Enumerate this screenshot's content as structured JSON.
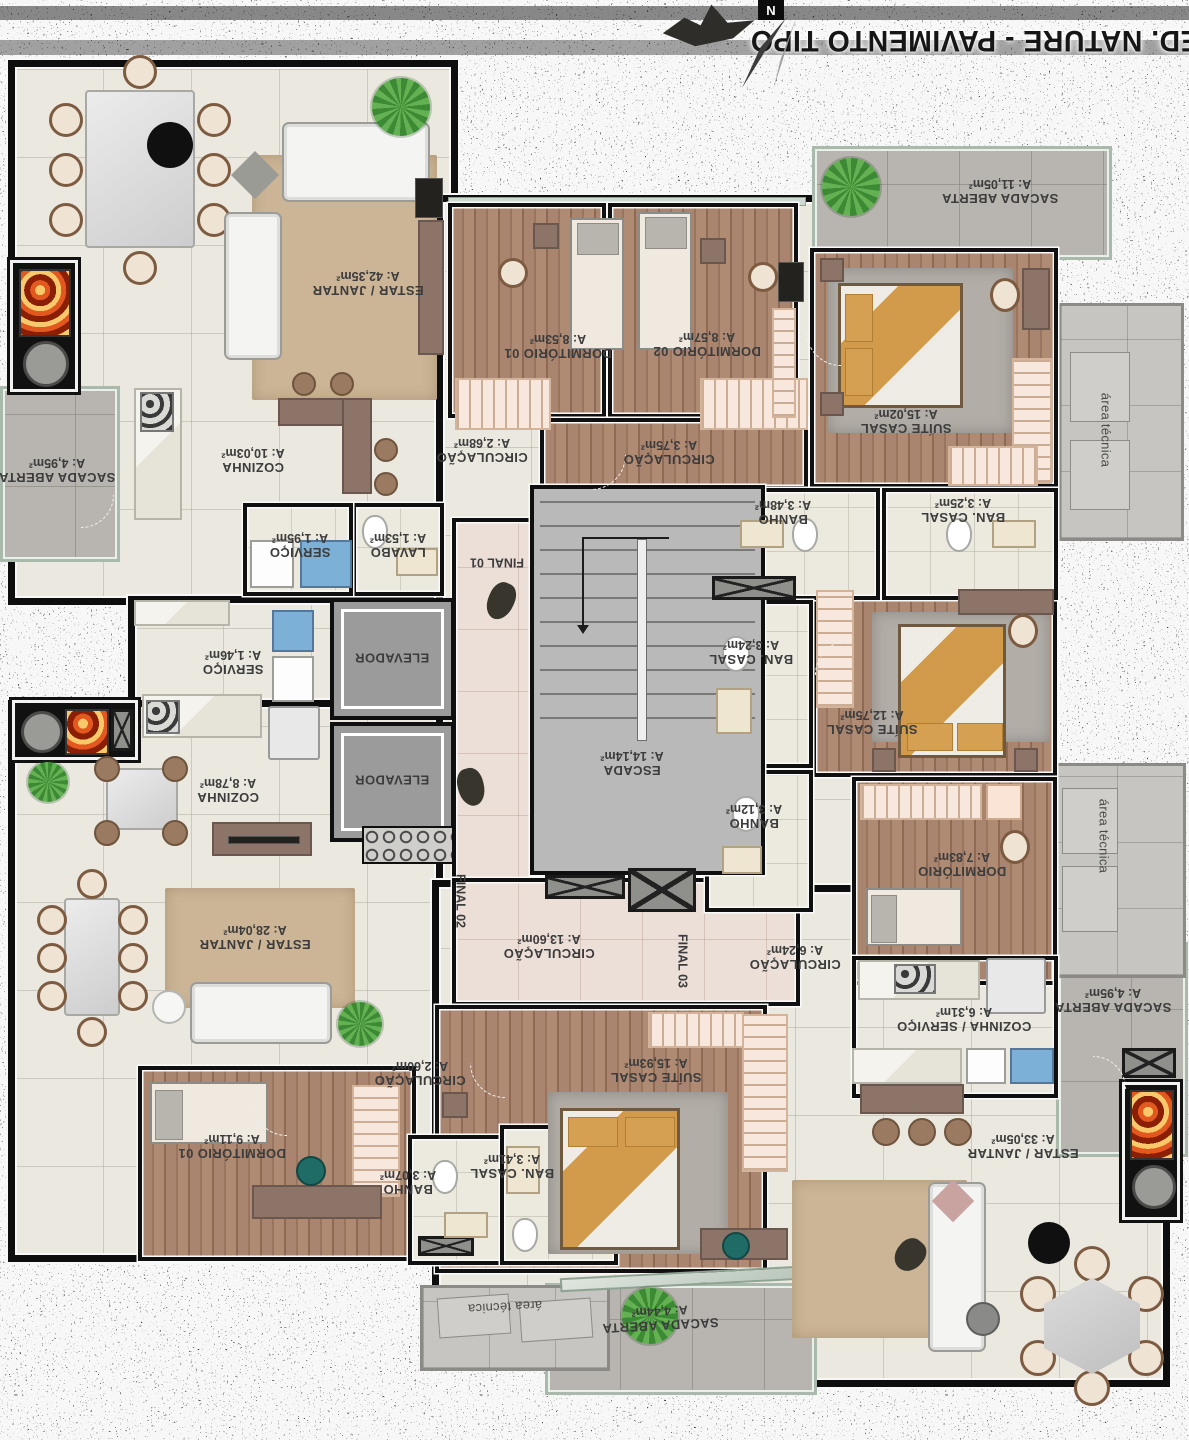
{
  "title": "ED. NATURE - PAVIMENTO TIPO",
  "rooms": [
    {
      "name": "ESTAR / JANTAR",
      "area": "A: 42,35m²"
    },
    {
      "name": "SACADA ABERTA",
      "area": "A: 4,95m²"
    },
    {
      "name": "COZINHA",
      "area": "A: 10,03m²"
    },
    {
      "name": "SERVIÇO",
      "area": "A: 1,95m²"
    },
    {
      "name": "LAVABO",
      "area": "A: 1,53m²"
    },
    {
      "name": "CIRCULAÇÃO",
      "area": "A: 2,68m²"
    },
    {
      "name": "SERVIÇO",
      "area": "A: 1,46m²"
    },
    {
      "name": "COZINHA",
      "area": "A: 8,78m²"
    },
    {
      "name": "ESTAR / JANTAR",
      "area": "A: 28,04m²"
    },
    {
      "name": "CIRCULAÇÃO",
      "area": "A: 2,60m²"
    },
    {
      "name": "DORMITÓRIO 01",
      "area": "A: 9,11m²"
    },
    {
      "name": "BANHO",
      "area": "A: 3,07m²"
    },
    {
      "name": "BAN. CASAL",
      "area": "A: 3,41m²"
    },
    {
      "name": "SUÍTE CASAL",
      "area": "A: 15,93m²"
    },
    {
      "name": "CIRCULAÇÃO",
      "area": "A: 13,60m²"
    },
    {
      "name": "ESCADA",
      "area": "A: 14,14m²"
    },
    {
      "name": "DORMITÓRIO 01",
      "area": "A: 8,53m²"
    },
    {
      "name": "DORMITÓRIO 02",
      "area": "A: 8,57m²"
    },
    {
      "name": "CIRCULAÇÃO",
      "area": "A: 3,75m²"
    },
    {
      "name": "SUÍTE CASAL",
      "area": "A: 15,02m²"
    },
    {
      "name": "BANHO",
      "area": "A: 3,48m²"
    },
    {
      "name": "BAN. CASAL",
      "area": "A: 3,25m²"
    },
    {
      "name": "SACADA ABERTA",
      "area": "A: 11,05m²"
    },
    {
      "name": "BAN. CASAL",
      "area": "A: 3,24m²"
    },
    {
      "name": "SUÍTE CASAL",
      "area": "A: 12,75m²"
    },
    {
      "name": "BANHO",
      "area": "A: 3,12m²"
    },
    {
      "name": "DORMITÓRIO",
      "area": "A: 7,83m²"
    },
    {
      "name": "CIRCULAÇÃO",
      "area": "A: 6,24m²"
    },
    {
      "name": "COZINHA / SERVIÇO",
      "area": "A: 6,31m²"
    },
    {
      "name": "SACADA ABERTA",
      "area": "A: 4,95m²"
    },
    {
      "name": "ESTAR / JANTAR",
      "area": "A: 33,05m²"
    },
    {
      "name": "SACADA ABERTA",
      "area": "A: 4,44m²"
    }
  ],
  "core": {
    "elevator": "ELEVADOR",
    "final_01": "FINAL 01",
    "final_02": "FINAL 02",
    "final_03": "FINAL 03"
  },
  "annotations": {
    "area_tecnica": "área técnica",
    "north": "N"
  },
  "colors": {
    "wall": "#0e0e0e",
    "tile_floor": "#eae8df",
    "hall_floor": "#ecdfd8",
    "wood_floor": "#a5816a",
    "balcony_floor": "#b8b5b0",
    "technical_area": "#c6c5c1",
    "stairs": "#b9b9b9",
    "bed_accent": "#d29a4b",
    "rug_tan": "#cbb596",
    "rug_gray": "#b2ada7",
    "closet": "#f7e7dc",
    "plant": "#4e9a44",
    "fire": "#e2581e"
  }
}
